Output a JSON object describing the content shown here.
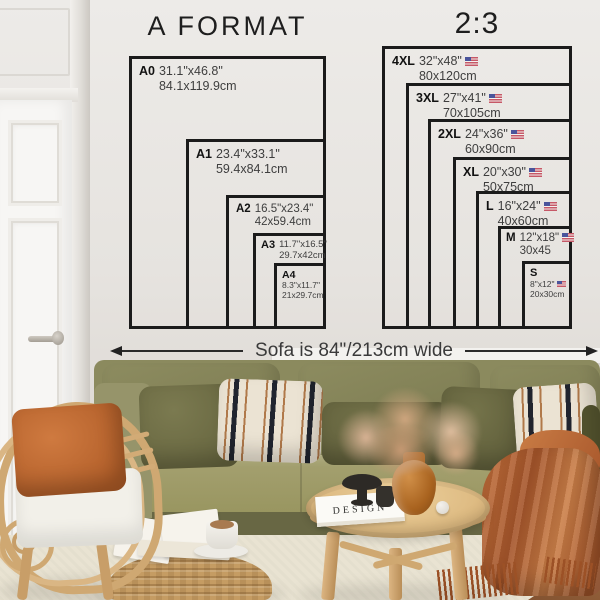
{
  "charts": {
    "a_format": {
      "title": "A FORMAT",
      "sizes": [
        {
          "code": "A0",
          "inches": "31.1\"x46.8\"",
          "cm": "84.1x119.9cm"
        },
        {
          "code": "A1",
          "inches": "23.4\"x33.1\"",
          "cm": "59.4x84.1cm"
        },
        {
          "code": "A2",
          "inches": "16.5\"x23.4\"",
          "cm": "42x59.4cm"
        },
        {
          "code": "A3",
          "inches": "11.7\"x16.5\"",
          "cm": "29.7x42cm"
        },
        {
          "code": "A4",
          "inches": "8.3\"x11.7\"",
          "cm": "21x29.7cm"
        }
      ]
    },
    "ratio_2_3": {
      "title": "2:3",
      "flag_icon": "us-flag",
      "sizes": [
        {
          "code": "4XL",
          "inches": "32\"x48\"",
          "cm": "80x120cm"
        },
        {
          "code": "3XL",
          "inches": "27\"x41\"",
          "cm": "70x105cm"
        },
        {
          "code": "2XL",
          "inches": "24\"x36\"",
          "cm": "60x90cm"
        },
        {
          "code": "XL",
          "inches": "20\"x30\"",
          "cm": "50x75cm"
        },
        {
          "code": "L",
          "inches": "16\"x24\"",
          "cm": "40x60cm"
        },
        {
          "code": "M",
          "inches": "12\"x18\"",
          "cm": "30x45"
        },
        {
          "code": "S",
          "inches": "8\"x12\"",
          "cm": "20x30cm"
        }
      ]
    }
  },
  "sofa_width_label": "Sofa is 84\"/213cm wide",
  "scene": {
    "book_title": "DESIGN"
  },
  "chart_data": {
    "type": "table",
    "title": "Poster size comparison on wall",
    "groups": [
      {
        "name": "A FORMAT",
        "rows": [
          [
            "A0",
            "31.1\"x46.8\"",
            "84.1x119.9cm"
          ],
          [
            "A1",
            "23.4\"x33.1\"",
            "59.4x84.1cm"
          ],
          [
            "A2",
            "16.5\"x23.4\"",
            "42x59.4cm"
          ],
          [
            "A3",
            "11.7\"x16.5\"",
            "29.7x42cm"
          ],
          [
            "A4",
            "8.3\"x11.7\"",
            "21x29.7cm"
          ]
        ]
      },
      {
        "name": "2:3",
        "rows": [
          [
            "4XL",
            "32\"x48\"",
            "80x120cm"
          ],
          [
            "3XL",
            "27\"x41\"",
            "70x105cm"
          ],
          [
            "2XL",
            "24\"x36\"",
            "60x90cm"
          ],
          [
            "XL",
            "20\"x30\"",
            "50x75cm"
          ],
          [
            "L",
            "16\"x24\"",
            "40x60cm"
          ],
          [
            "M",
            "12\"x18\"",
            "30x45"
          ],
          [
            "S",
            "8\"x12\"",
            "20x30cm"
          ]
        ]
      }
    ],
    "annotation": "Sofa is 84\"/213cm wide"
  },
  "colors": {
    "chart_line": "#1b1b1b",
    "wall": "#e6e3df",
    "sofa_olive": "#8b8a5e",
    "pillow_rust": "#c06a33",
    "throw_rust": "#b4612e",
    "rattan": "#d2ab76",
    "flag_red": "#c65867",
    "flag_blue": "#4a549b"
  }
}
